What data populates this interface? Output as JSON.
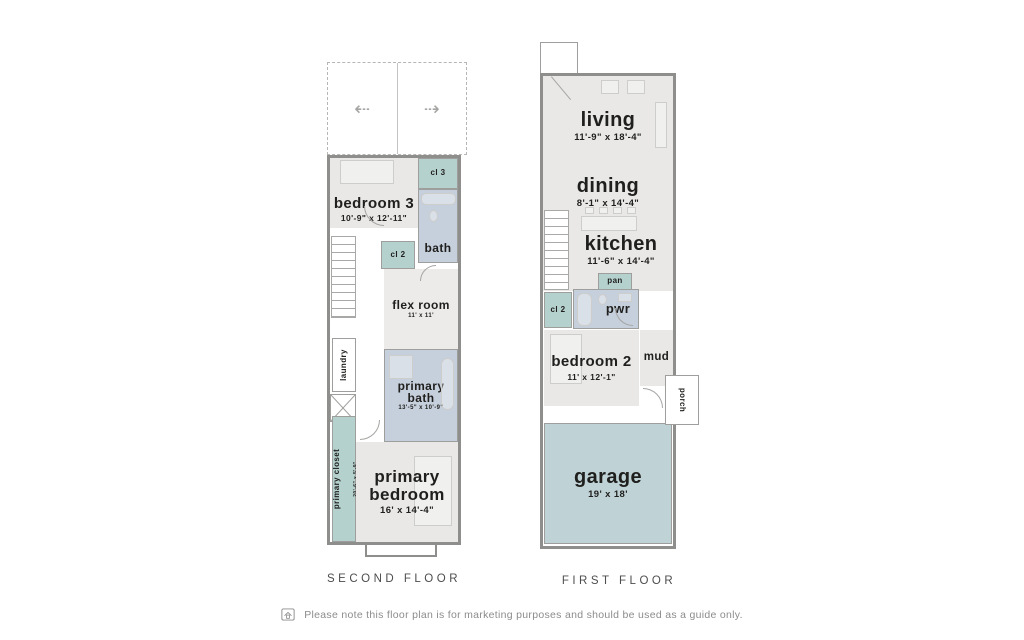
{
  "colors": {
    "room_fill": "#e9e8e6",
    "bath_fill": "#c6cfdc",
    "closet_fill": "#b5d1ce",
    "garage_fill": "#bfd2d6",
    "wall": "#8e8e8c",
    "label_text": "#1f1f1d",
    "floor_label_text": "#4d4d4d",
    "muted_text": "#8c8c8c"
  },
  "second_floor": {
    "label": "SECOND FLOOR",
    "roof_deck": {
      "arrow_left_icon": "⇠",
      "arrow_right_icon": "⇢"
    },
    "rooms": {
      "bedroom3": {
        "name": "bedroom 3",
        "dims": "10'-9\" x 12'-11\""
      },
      "cl3": {
        "name": "cl 3"
      },
      "bath": {
        "name": "bath"
      },
      "cl2": {
        "name": "cl 2"
      },
      "flex_room": {
        "name": "flex room",
        "dims": "11' x 11'"
      },
      "laundry": {
        "name": "laundry"
      },
      "primary_bath": {
        "name": "primary bath",
        "dims": "13'-5\" x 10'-9\""
      },
      "primary_closet": {
        "name": "primary closet",
        "dims": "20'-6\" x 5'-9\""
      },
      "primary_bedroom": {
        "name": "primary bedroom",
        "dims": "16' x 14'-4\""
      }
    }
  },
  "first_floor": {
    "label": "FIRST FLOOR",
    "rooms": {
      "living": {
        "name": "living",
        "dims": "11'-9\" x 18'-4\""
      },
      "dining": {
        "name": "dining",
        "dims": "8'-1\" x 14'-4\""
      },
      "kitchen": {
        "name": "kitchen",
        "dims": "11'-6\" x 14'-4\""
      },
      "pan": {
        "name": "pan"
      },
      "cl2": {
        "name": "cl 2"
      },
      "pwr": {
        "name": "pwr"
      },
      "bedroom2": {
        "name": "bedroom 2",
        "dims": "11' x 12'-1\""
      },
      "mud": {
        "name": "mud"
      },
      "porch": {
        "name": "porch"
      },
      "garage": {
        "name": "garage",
        "dims": "19' x 18'"
      }
    }
  },
  "footer": {
    "disclaimer": "Please note this floor plan is for marketing purposes and should be used as a guide only."
  }
}
